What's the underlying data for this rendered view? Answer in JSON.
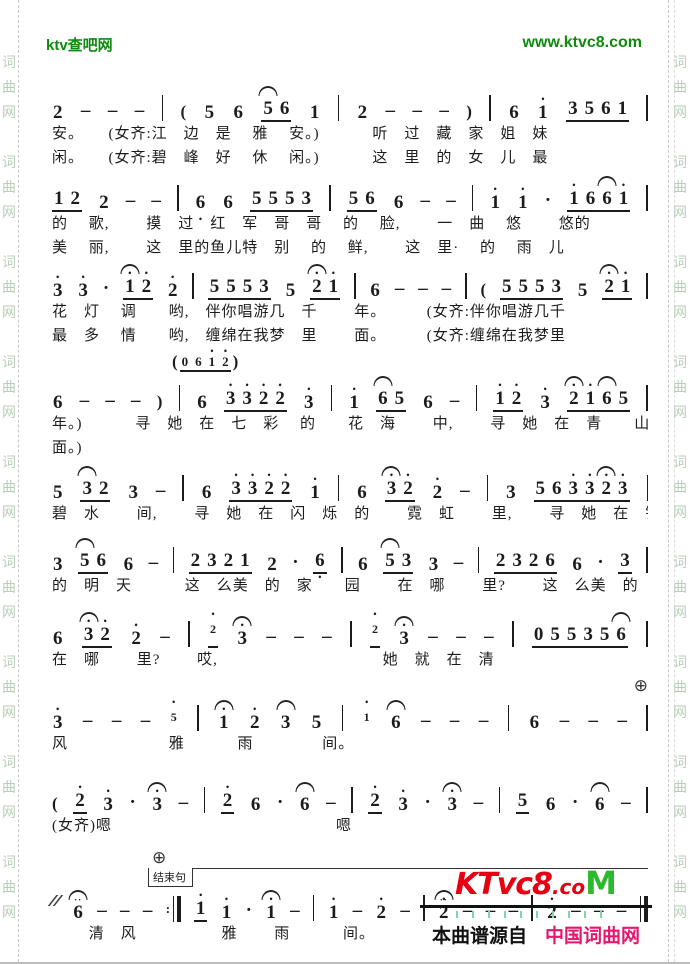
{
  "header": {
    "site_name": "ktv查吧网",
    "site_url": "www.ktvc8.com"
  },
  "watermark": {
    "chars": [
      "词",
      "曲",
      "网"
    ]
  },
  "colors": {
    "header_green": "#0f8a0f",
    "watermark_green": "#b9ceb9",
    "logo_red": "#e60012",
    "logo_green": "#2db92d",
    "caption_pink": "#e5176e",
    "ink": "#1c1c1c"
  },
  "score": {
    "coda_symbol": "⊕",
    "systems": [
      {
        "notes": "2 - - - | ( 5 6 5_^ 6_ 1 | 2 - - - ) | 6 1' 3_ 5_ 6_ 1_ |",
        "lyrics": [
          "安。　　(女齐:江　边　是　 雅　 安。)　　　 听　过　藏　家　姐　妹",
          "闲。　　(女齐:碧　峰　好　 休　 闲。)　　　 这　里　的　女　儿　最"
        ]
      },
      {
        "notes": "1_ 2_ 2 - - | 6, 6 5_ 5_ 5_ 3_ | 5_ 6_ 6 - - | 1' 1' . 1'_ 6_ 6_^ 1'_ |",
        "lyrics": [
          "的　 歌,　　 摸　过　红　军　哥　哥　 的　 脸,　　 一　曲　 悠　　 悠的",
          "美　 丽,　　 这　里的鱼儿特　别　 的　 鲜,　　 这　里·　 的　 雨　儿"
        ]
      },
      {
        "notes": "3' 3' . 1'_^ 2'_ 2' | 5_ 5_ 5_ 3_ 5 2'_^ 1'_ | 6 - - - | ( 5_ 5_ 5_ 3_ 5 2'_^ 1'_ |",
        "lyrics": [
          "花　灯　 调　　哟,　伴你唱游几　千　　 年。　　　(女齐:伴你唱游几千",
          "最　多　 情　　哟,　缠绵在我梦　里　　 面。　　　(女齐:缠绵在我梦里"
        ]
      },
      {
        "notes": "6 - - - ) | 6 3'_ 3'_ 2'_ 2'_ 3' | 1' 6_^ 5_ 6 - | 1'_ 2'_ 3' 2'_^ 1'_ 6_^ 5_ |",
        "pickup": "( 0_ 6_ 1'_ 2'_ )",
        "lyrics": [
          "年。)　　　 寻　她　在　七　彩　 的　　花　海　　 中,　　 寻　她　在　青　　山",
          "面。)"
        ]
      },
      {
        "notes": "5 3_^ 2_ 3 - | 6 3'_ 3'_ 2'_ 2'_ 1' | 6 3'_^ 2'_ 2' - | 3 5_ 6_ 3'_ 3'_ 2'_^ 3'_ |",
        "lyrics": [
          "碧　水　　 间,　　 寻　她　在　闪　烁　的　　 霓　虹　　 里,　　 寻　她　在　锦　绣　如画"
        ]
      },
      {
        "notes": "3 5_^ 6_ 6 - | 2_ 3_ 2_ 1_ 2 . 6,_ | 6 5_^ 3_ 3 - | 2_ 3_ 2_ 6_ 6 . 3_ |",
        "lyrics": [
          "的　明　天　　　 这　么美　的　家　　园　　 在　哪　　 里?　　 这　么美　的　家　　园"
        ]
      },
      {
        "notes": "6 3'_^ 2'_ 2' - | g2'_ 3'^ - - - | g2'_ 3'^ - - - | 0_ 5_ 5_ 3_ 5_ 6_^ |",
        "lyrics": [
          "在　哪　　 里?　　 哎,　　　　　　　　　　 她　就　在　清"
        ]
      },
      {
        "notes": "3' - - - g5' | 1'^ 2' 3^ 5 | g1' 6^ - - - | 6 - - - |",
        "coda": true,
        "lyrics": [
          "风　　　　　　 雅　　　 雨　　　　 间。"
        ]
      },
      {
        "notes": "( 2'_ 3' . 3'^ - | 2'_ 6 . 6^ - | 2'_ 3' . 3'^ - | 5_ 6 . 6^ - |",
        "lyrics": [
          "(女齐)嗯　　　　　　　　　　　　　　嗯"
        ]
      },
      {
        "notes": "// 6f - - - :| 1'_ 1' . 1'^ - | 1' - 2' - | 2'f - - - | 2' - - - ||",
        "end_label": "结束句",
        "lyrics": [
          "　　 清　风　　　　　 雅　　 雨　　　 间。"
        ]
      }
    ]
  },
  "footer": {
    "logo_main": "KTvc8",
    "logo_dot": ".co",
    "logo_m": "M",
    "caption_black": "本曲谱源自",
    "caption_red": "中国词曲网"
  }
}
